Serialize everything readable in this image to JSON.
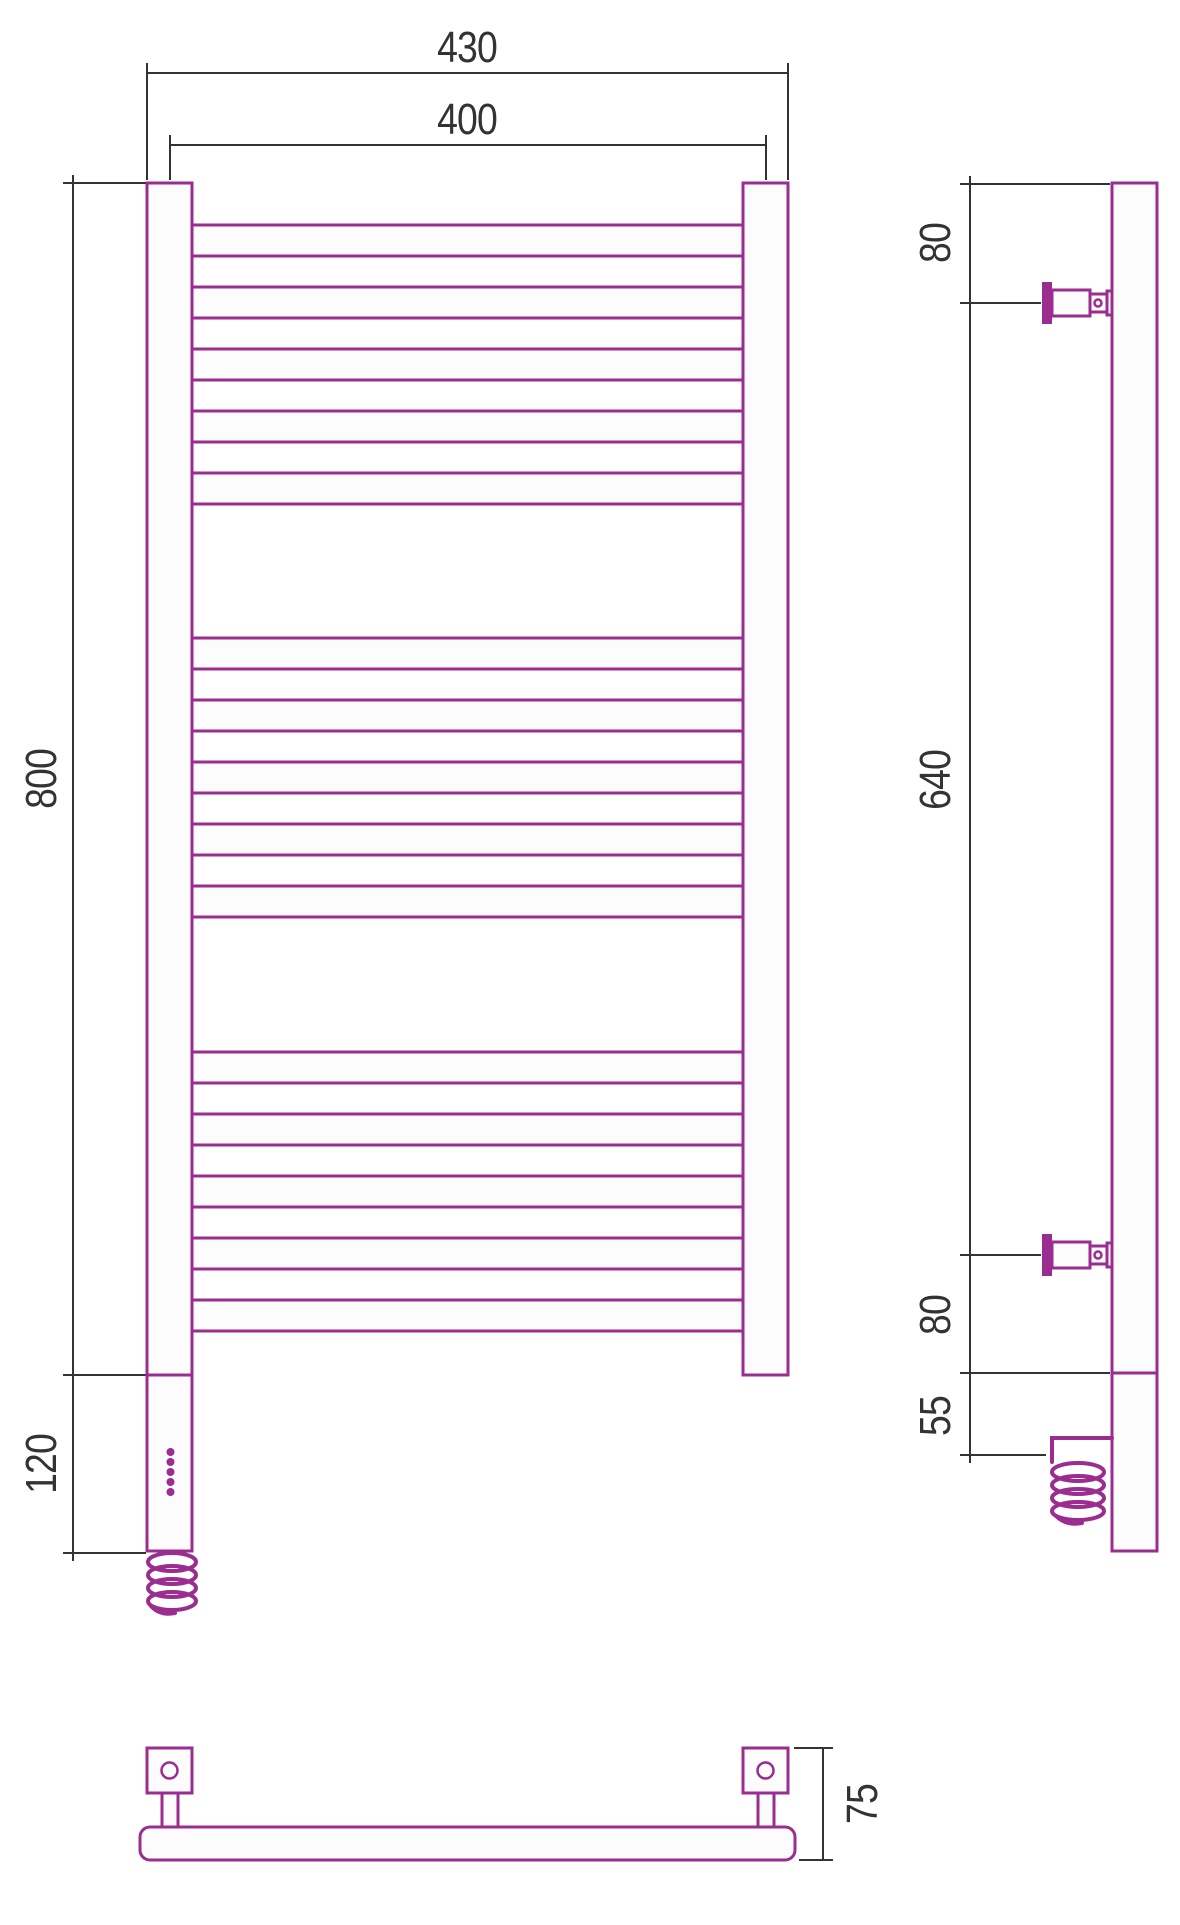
{
  "drawing": {
    "title": "heated-towel-rail-dimension-drawing",
    "accent_color": "#9a2d8f",
    "line_color": "#333333",
    "fill_color": "#fdfcfd"
  },
  "dimensions": {
    "front": {
      "overall_width": "430",
      "axis_width": "400",
      "height": "800",
      "housing_height": "120"
    },
    "side": {
      "top_offset": "80",
      "bracket_span": "640",
      "bottom_offset": "80",
      "cable_offset": "55"
    },
    "bottom": {
      "depth": "75"
    }
  },
  "structure": {
    "rung_groups": [
      5,
      5,
      5
    ],
    "led_dots": 5
  }
}
